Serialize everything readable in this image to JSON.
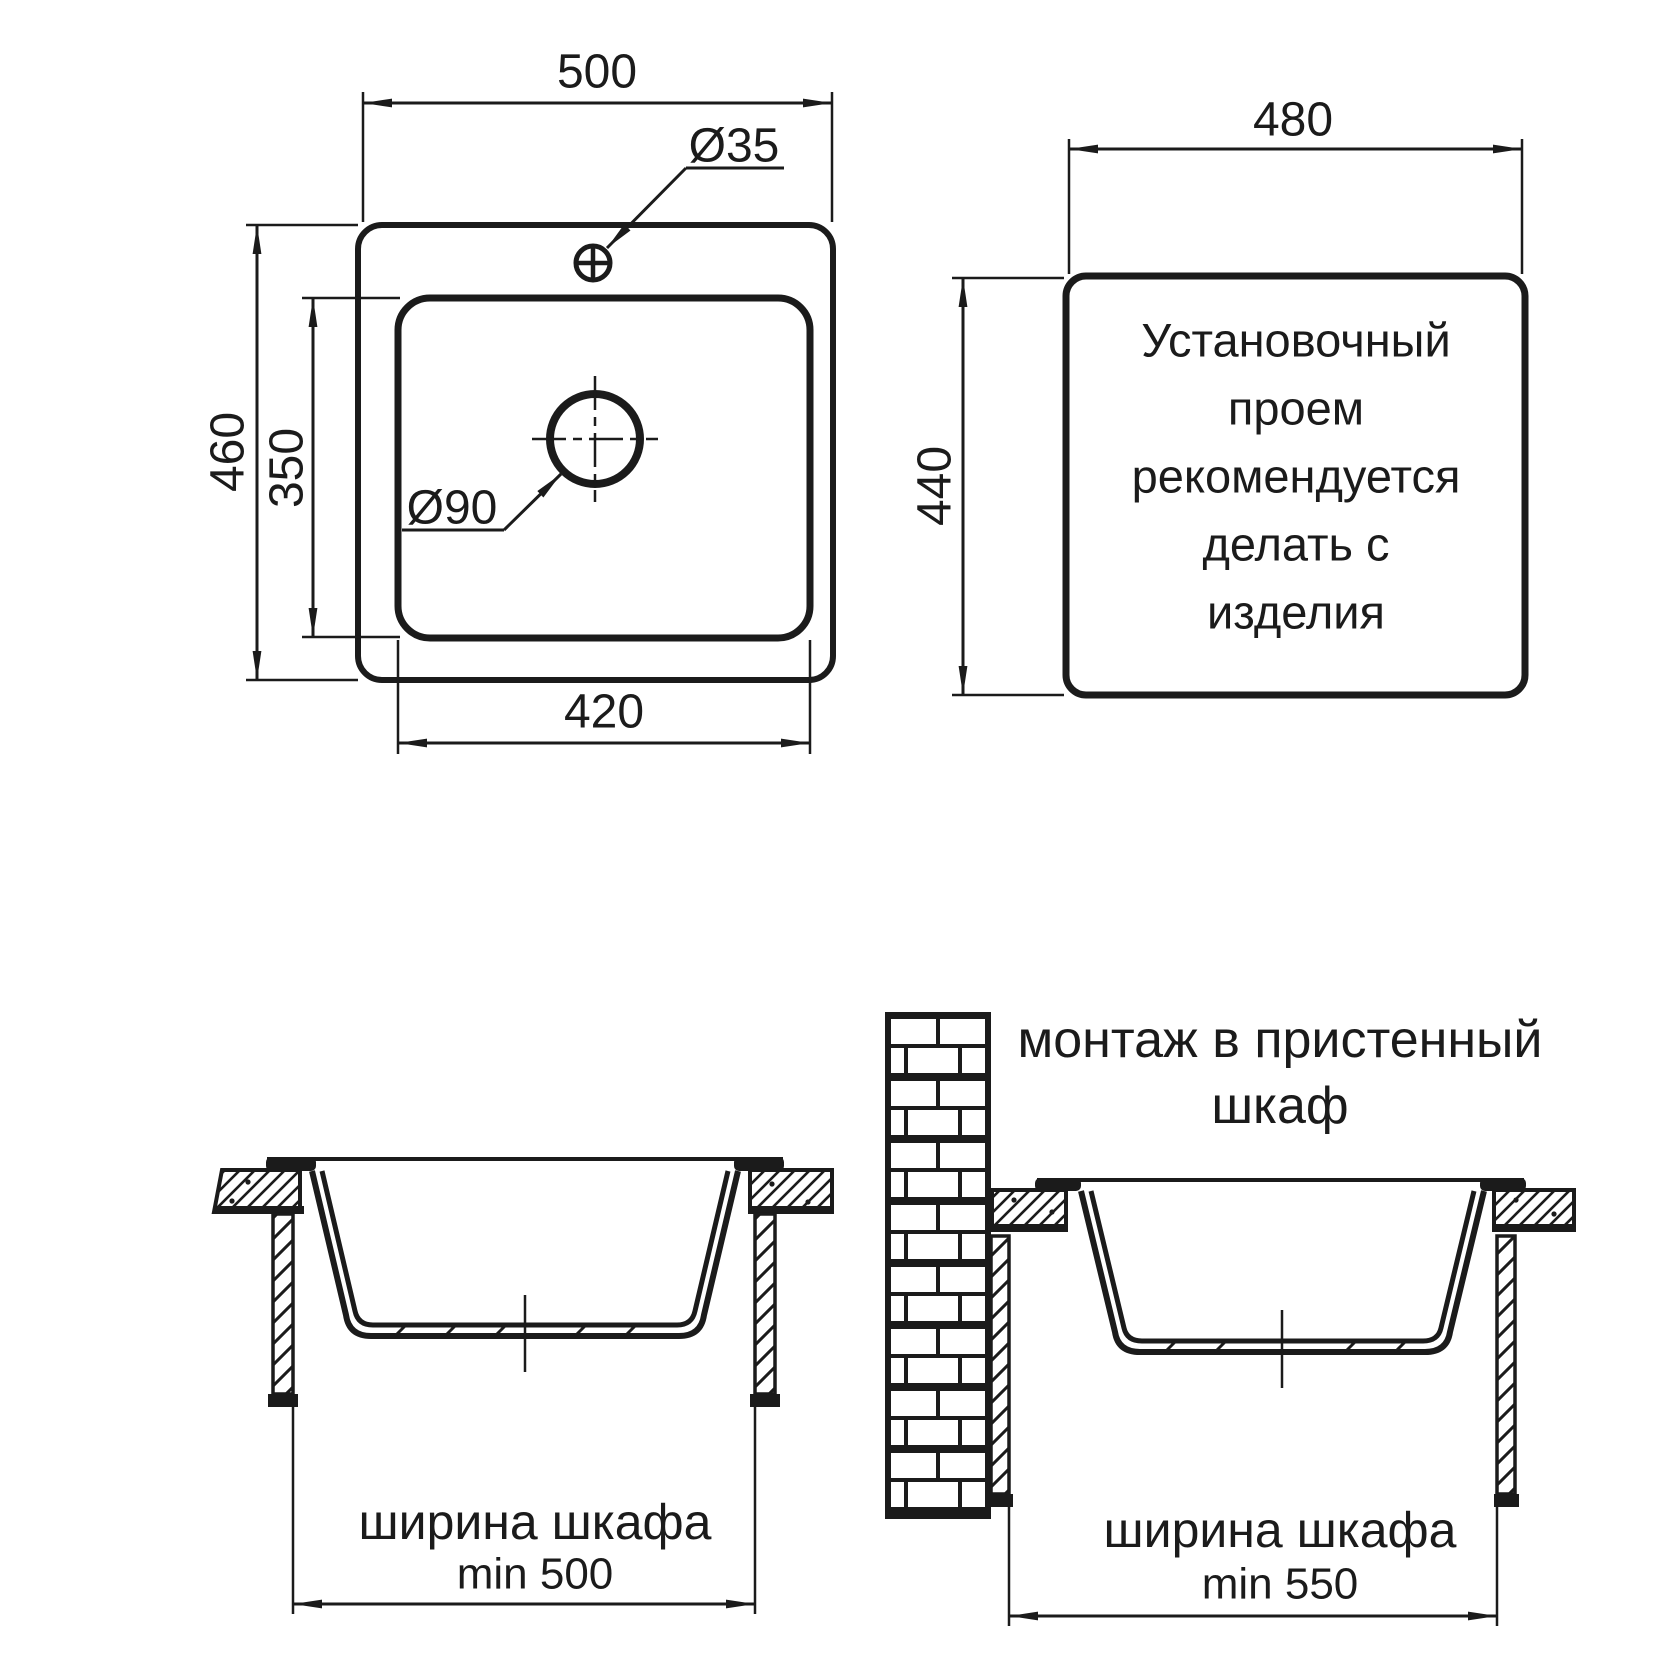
{
  "top_view": {
    "overall_width": "500",
    "overall_depth": "460",
    "bowl_depth": "350",
    "bowl_width": "420",
    "faucet_hole_diameter": "Ø35",
    "drain_hole_diameter": "Ø90"
  },
  "cutout_view": {
    "cutout_width": "480",
    "cutout_depth": "440",
    "note_lines": [
      "Установочный",
      "проем",
      "рекомендуется",
      "делать с",
      "изделия"
    ]
  },
  "cabinet_section": {
    "cabinet_width_label": "ширина шкафа",
    "cabinet_min_width": "min 500"
  },
  "wall_cabinet_section": {
    "title_line_1": "монтаж в пристенный",
    "title_line_2": "шкаф",
    "cabinet_width_label": "ширина шкафа",
    "cabinet_min_width": "min 550"
  },
  "colors": {
    "line": "#1b1b1b",
    "background": "#ffffff"
  }
}
